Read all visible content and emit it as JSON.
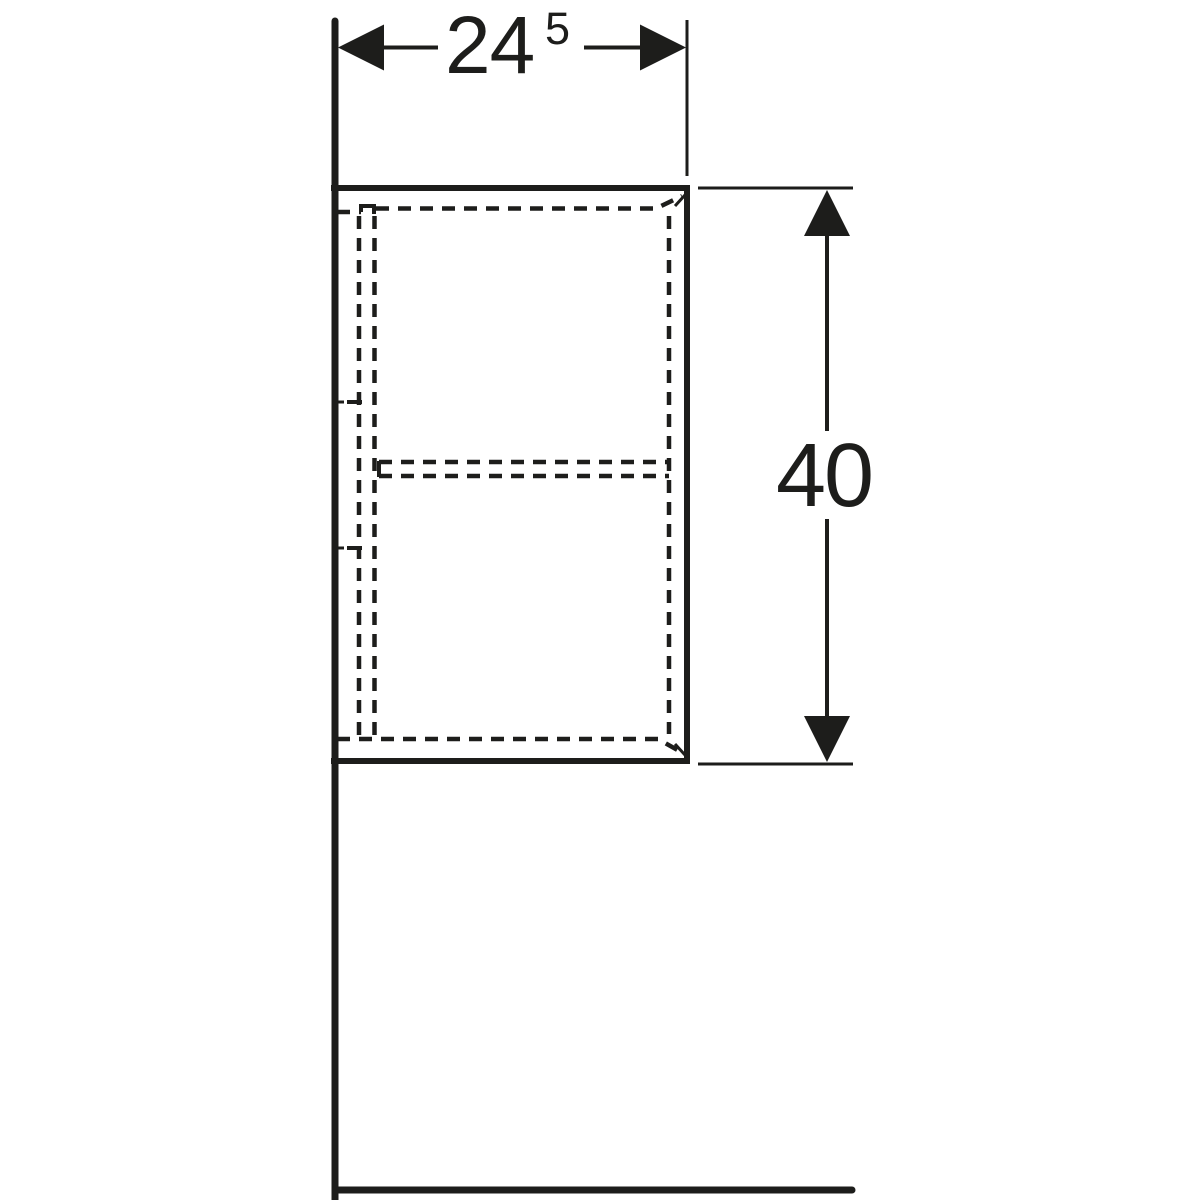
{
  "drawing": {
    "kind": "technical dimension drawing",
    "subject": "wall-hung cabinet, side elevation with hidden edges (dashed) shown against wall and floor lines",
    "line_color": "#1d1d1b",
    "background_color": "#ffffff",
    "dimensions": {
      "width": {
        "value": "24",
        "superscript": "5",
        "display": "24.5"
      },
      "height": {
        "value": "40",
        "display": "40"
      }
    }
  }
}
